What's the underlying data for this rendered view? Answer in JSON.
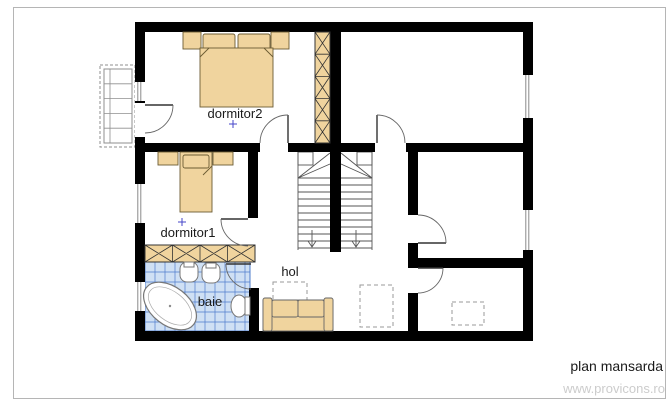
{
  "plan": {
    "title": "plan mansarda",
    "watermark": "www.provicons.ro",
    "rooms": {
      "dormitor2": "dormitor2",
      "dormitor1": "dormitor1",
      "baie": "baie",
      "hol": "hol"
    },
    "colors": {
      "wall": "#000000",
      "furniture_fill": "#f0d49e",
      "furniture_stroke": "#6b5b33",
      "tile_fill": "#cfe0f4",
      "tile_line": "#4f7ccb",
      "fixture_stroke": "#777777",
      "door_arc": "#666666",
      "stair_line": "#555555",
      "dashed_outline": "#9a9a9a",
      "label": "#1a1a1a",
      "cross_marker": "#4646c8",
      "watermark": "#cccccc",
      "frame": "#b5b5b5"
    }
  }
}
